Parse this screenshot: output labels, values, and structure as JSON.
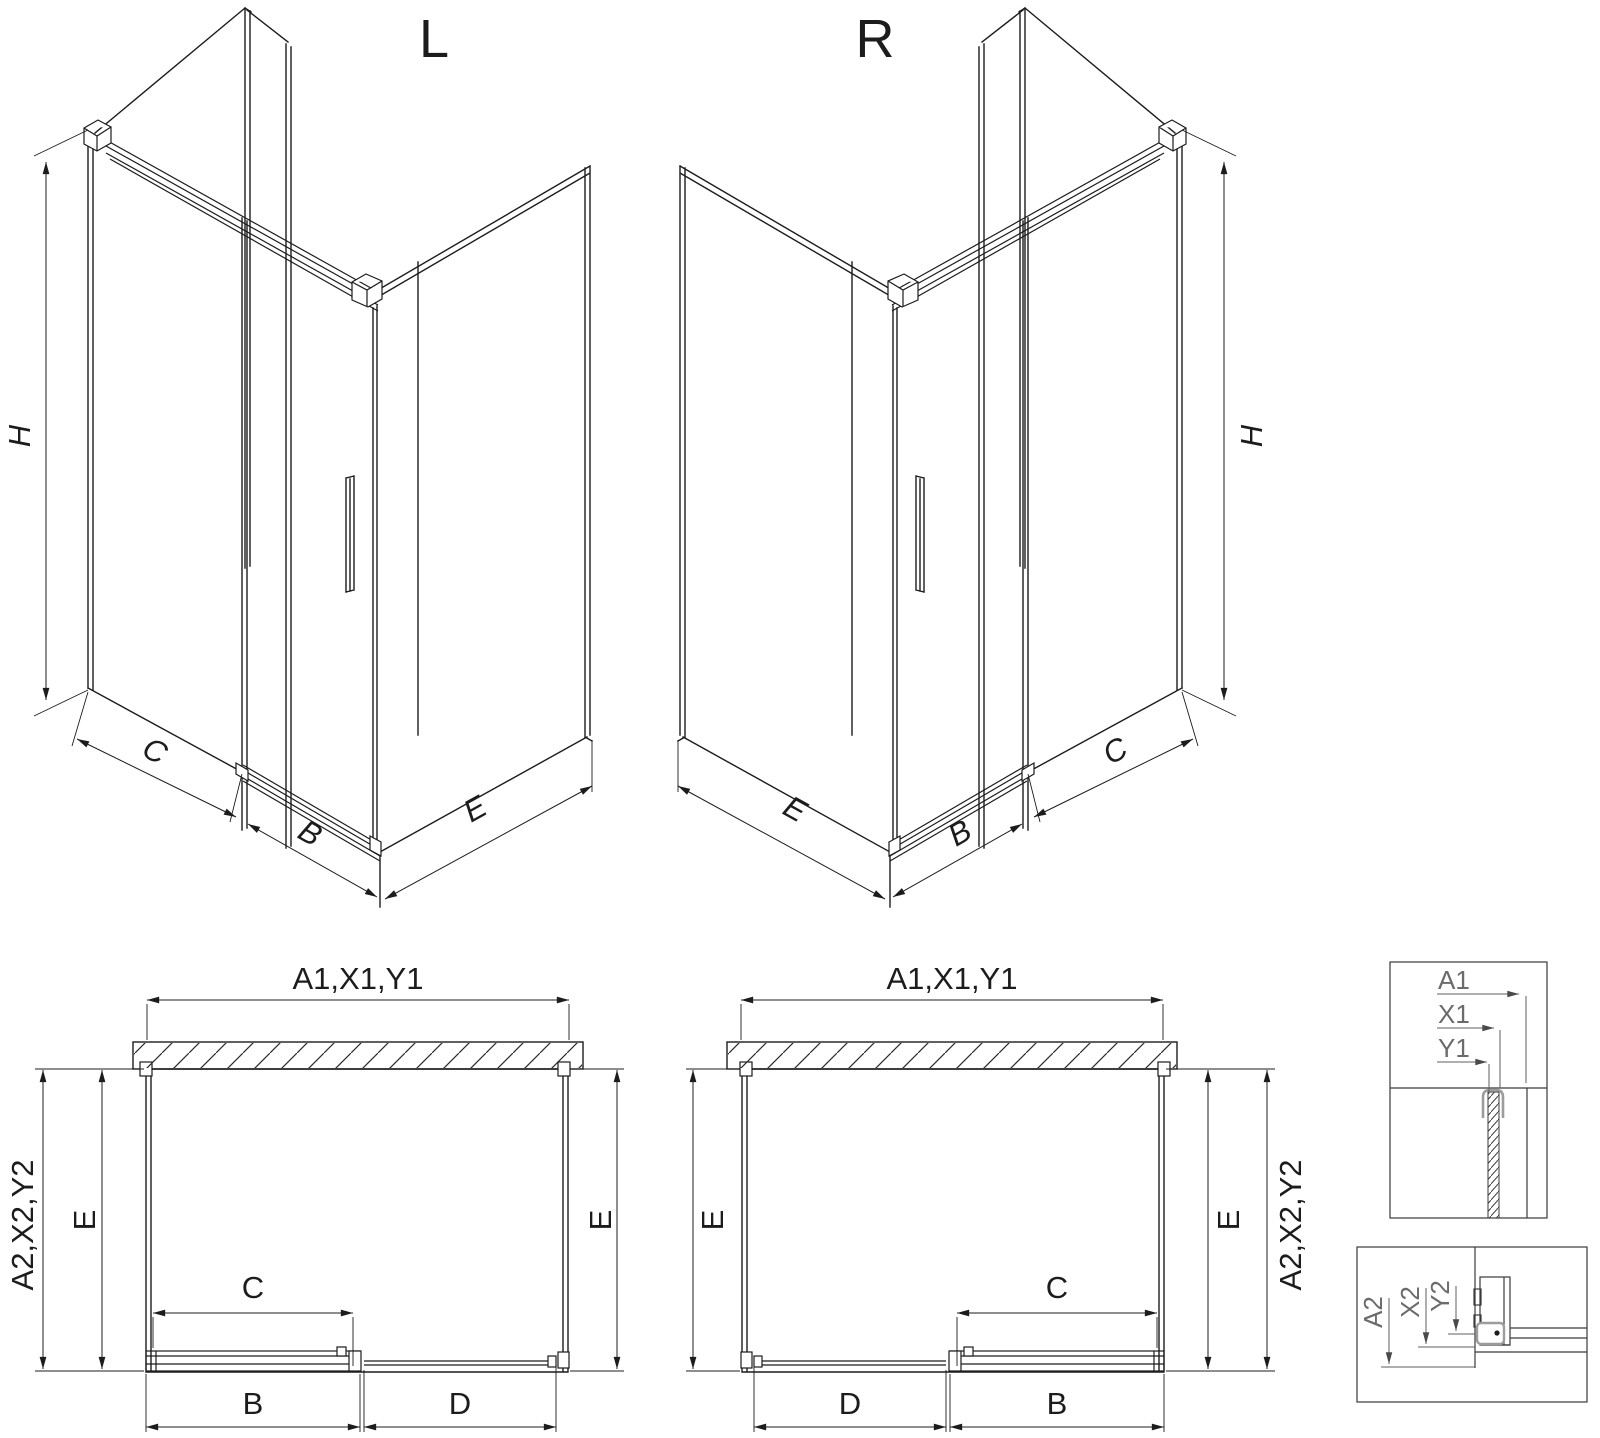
{
  "titles": {
    "left": "L",
    "right": "R"
  },
  "iso_dims": {
    "height": "H",
    "segment_c": "C",
    "segment_b": "B",
    "side_e": "E"
  },
  "plan_dims": {
    "width_top": "A1,X1,Y1",
    "depth_side": "A2,X2,Y2",
    "depth_e": "E",
    "clear_c": "C",
    "door_b": "B",
    "panel_d": "D"
  },
  "detail_top": {
    "a1": "A1",
    "x1": "X1",
    "y1": "Y1"
  },
  "detail_bottom": {
    "a2": "A2",
    "x2": "X2",
    "y2": "Y2"
  },
  "colors": {
    "line": "#1c1c1c",
    "detail_label": "#6b6b6b",
    "clamp_profile": "#9c9c9c",
    "background": "#ffffff"
  }
}
